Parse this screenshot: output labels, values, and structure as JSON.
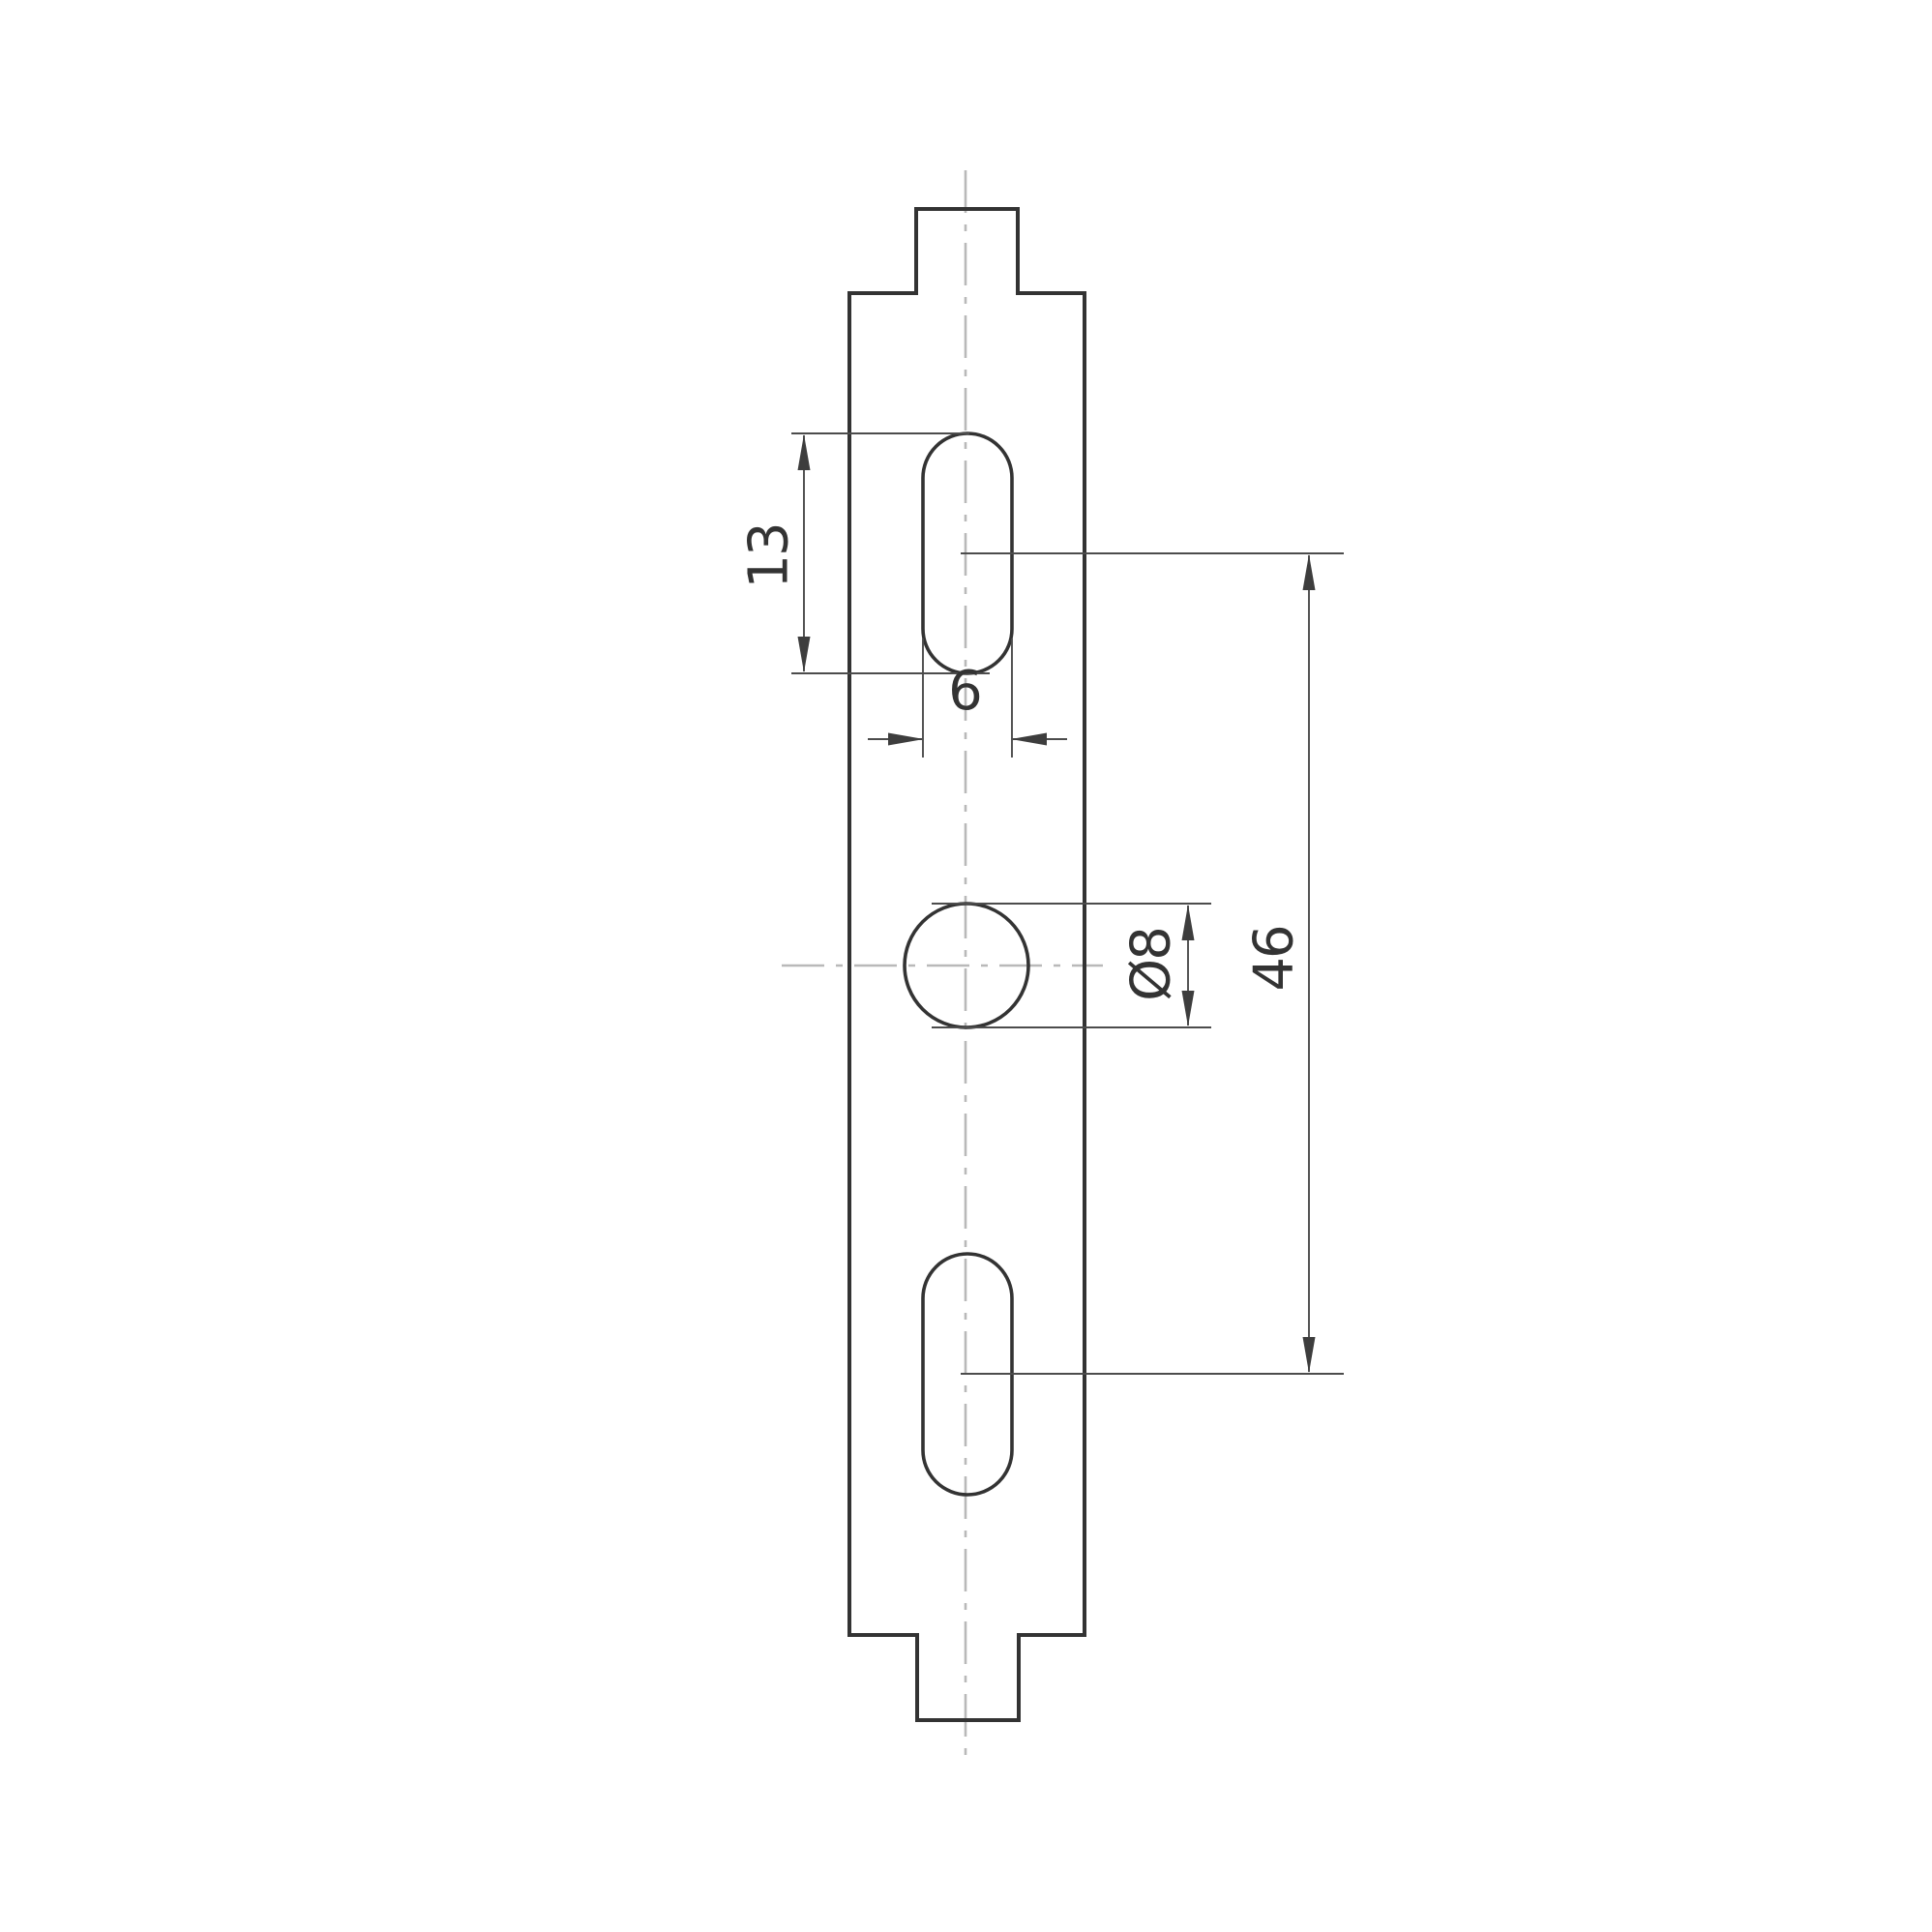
{
  "page": {
    "background": "#ffffff"
  },
  "drawing": {
    "kind": "engineering-dimension-drawing",
    "colors": {
      "outline": "#333333",
      "thin_line": "#4c4c4c",
      "centerline": "#b9b9b9",
      "arrow": "#3d3d3d",
      "text": "#333333"
    },
    "labels": {
      "slot_length": "13",
      "slot_width": "6",
      "hole_diameter": "Ø8",
      "hole_spacing": "46"
    }
  }
}
